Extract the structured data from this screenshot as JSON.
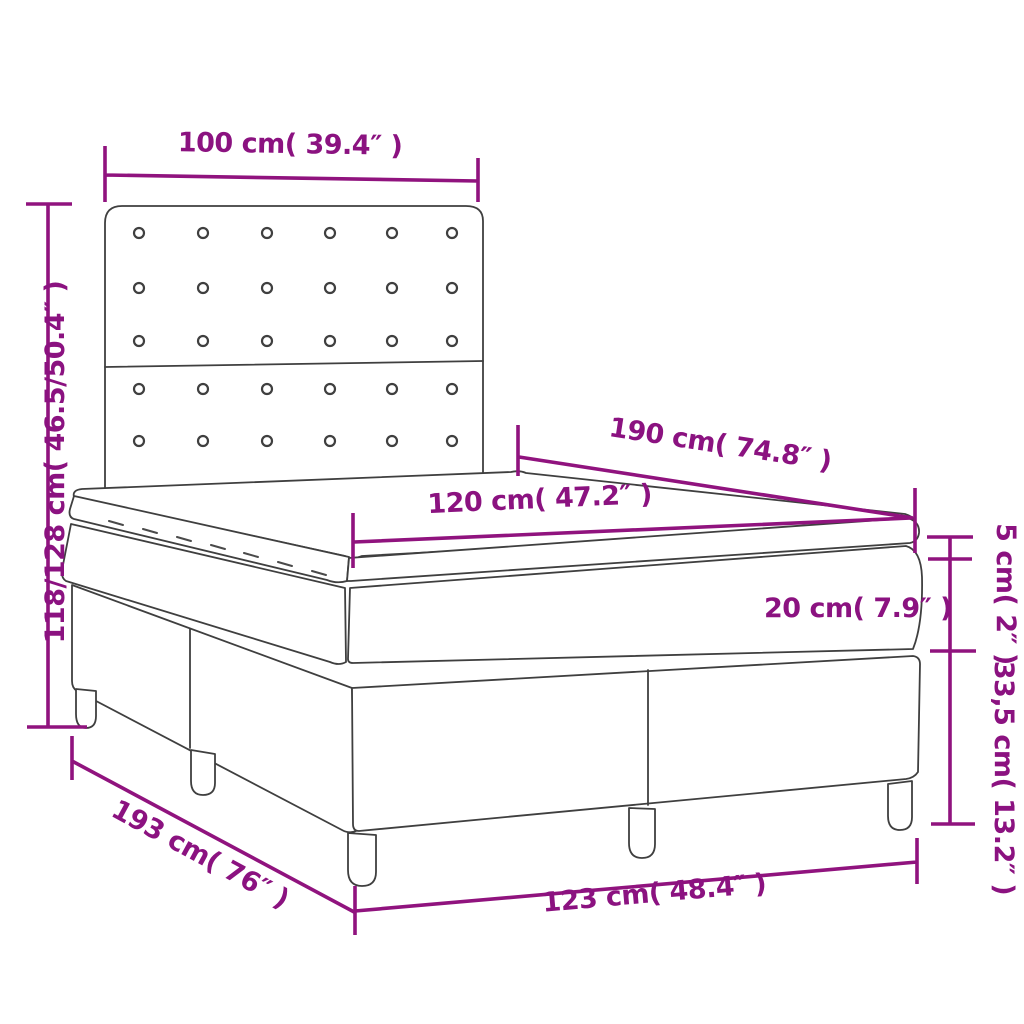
{
  "diagram_type": "product dimension diagram",
  "product": "box spring bed with tufted headboard, mattress and pillow topper",
  "colors": {
    "dimension_accent": "#90137E",
    "label_text": "#8B1280",
    "line_art": "#3F3F3F",
    "background": "#FFFFFF"
  },
  "labels": {
    "headboard_width": "100 cm( 39.4″ )",
    "overall_height": "118/128 cm( 46.5/50.4″ )",
    "mattress_length": "190 cm( 74.8″ )",
    "mattress_width": "120 cm( 47.2″ )",
    "topper_thickness": "5 cm( 2″ )",
    "mattress_thickness": "20 cm( 7.9″ )",
    "base_height": "33,5 cm( 13.2″ )",
    "frame_length": "193 cm( 76″ )",
    "frame_width": "123 cm( 48.4″ )"
  },
  "headboard": {
    "button_rows": 5,
    "button_columns": 6
  }
}
